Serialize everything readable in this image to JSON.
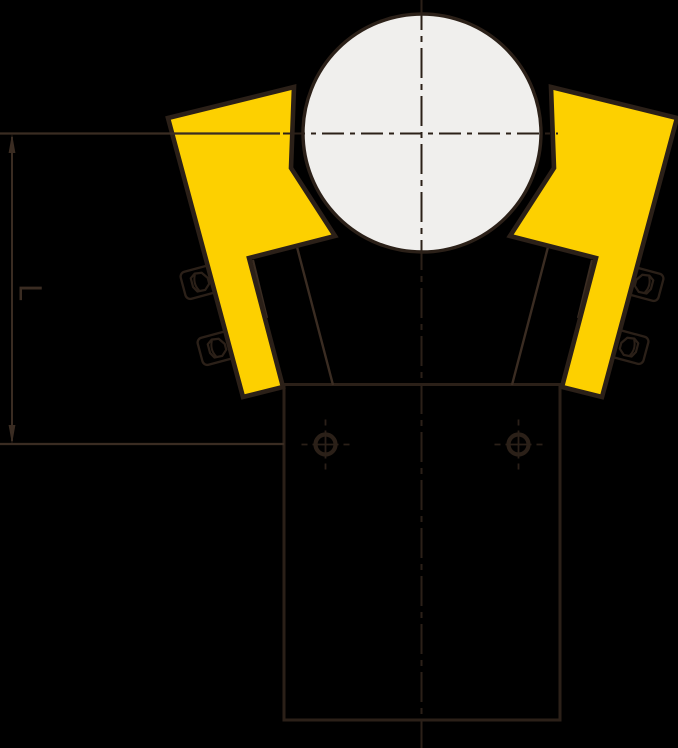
{
  "diagram": {
    "type": "technical-drawing",
    "description": "Side view of a clamp: round shaft gripped by two yellow jaws with side bolts, body with rectangular shank, two mounting holes, centerlines and vertical dimension L",
    "canvas": {
      "width": 678,
      "height": 748,
      "background": "#000000"
    },
    "colors": {
      "outline": "#2b2018",
      "thin": "#3a2c22",
      "yellow": "#fdd000",
      "roller": "#f0efed",
      "dim": "#3a2c22"
    },
    "dimension": {
      "label": "L"
    },
    "shapes": [
      {
        "type": "rect",
        "name": "shank-outline",
        "x": 284,
        "y": 384.5,
        "w": 276,
        "h": 335.5,
        "stroke": "outline",
        "sw": 3,
        "fill": "none"
      },
      {
        "type": "line",
        "name": "body-neck-edge-left",
        "x1": 297,
        "y1": 247,
        "x2": 333,
        "y2": 385,
        "stroke": "thin",
        "sw": 2.4
      },
      {
        "type": "line",
        "name": "body-neck-edge-right",
        "x1": 548,
        "y1": 247,
        "x2": 512,
        "y2": 385,
        "stroke": "thin",
        "sw": 2.4
      },
      {
        "type": "line",
        "name": "body-edge-stub-left",
        "x1": 253,
        "y1": 260,
        "x2": 267,
        "y2": 318,
        "stroke": "thin",
        "sw": 2.2
      },
      {
        "type": "line",
        "name": "body-edge-stub-right",
        "x1": 592,
        "y1": 260,
        "x2": 578,
        "y2": 318,
        "stroke": "thin",
        "sw": 2.2
      },
      {
        "type": "bolt",
        "name": "gib-bolt-left-upper",
        "cx": 200,
        "cy": 282,
        "rot": -15,
        "flip": false
      },
      {
        "type": "bolt",
        "name": "gib-bolt-left-lower",
        "cx": 217,
        "cy": 348,
        "rot": -15,
        "flip": false
      },
      {
        "type": "bolt",
        "name": "gib-bolt-right-upper",
        "cx": 644,
        "cy": 284,
        "rot": 15,
        "flip": true
      },
      {
        "type": "bolt",
        "name": "gib-bolt-right-lower",
        "cx": 629,
        "cy": 347,
        "rot": 15,
        "flip": true
      },
      {
        "type": "polygon",
        "name": "clamp-jaw-left",
        "points": [
          [
            168,
            118
          ],
          [
            294,
            87
          ],
          [
            291,
            168
          ],
          [
            335,
            236
          ],
          [
            249,
            258
          ],
          [
            283,
            387
          ],
          [
            243,
            397
          ]
        ],
        "fill": "yellow",
        "stroke": "outline",
        "sw": 4.6
      },
      {
        "type": "polygon",
        "name": "clamp-jaw-right",
        "points": [
          [
            677,
            118
          ],
          [
            551,
            87
          ],
          [
            554,
            168
          ],
          [
            510,
            236
          ],
          [
            596,
            258
          ],
          [
            562,
            387
          ],
          [
            602,
            397
          ]
        ],
        "fill": "yellow",
        "stroke": "outline",
        "sw": 4.6
      },
      {
        "type": "circle",
        "name": "shaft-roller",
        "cx": 422,
        "cy": 133,
        "r": 119,
        "fill": "roller",
        "stroke": "outline",
        "sw": 3.4
      },
      {
        "type": "line",
        "name": "centerline-vertical",
        "x1": 421.5,
        "y1": 0,
        "x2": 421.5,
        "y2": 748,
        "stroke": "outline",
        "sw": 2,
        "dash": "30 6 6 6"
      },
      {
        "type": "line",
        "name": "centerline-horizontal",
        "x1": 283,
        "y1": 133.5,
        "x2": 558,
        "y2": 133.5,
        "stroke": "outline",
        "sw": 2,
        "dash": "22 6 5 6"
      },
      {
        "type": "line",
        "name": "extension-line-top",
        "x1": 0,
        "y1": 133.5,
        "x2": 280,
        "y2": 133.5,
        "stroke": "thin",
        "sw": 2.2
      },
      {
        "type": "line",
        "name": "extension-line-bottom",
        "x1": 0,
        "y1": 444,
        "x2": 284,
        "y2": 444,
        "stroke": "thin",
        "sw": 2.2
      },
      {
        "type": "line",
        "name": "dimension-line-vertical",
        "x1": 12,
        "y1": 137,
        "x2": 12,
        "y2": 441,
        "stroke": "dim",
        "sw": 2
      },
      {
        "type": "polygon",
        "name": "dimension-arrow-up",
        "points": [
          [
            12,
            134
          ],
          [
            8.6,
            153
          ],
          [
            15.4,
            153
          ]
        ],
        "fill": "dim",
        "stroke": "none",
        "sw": 0
      },
      {
        "type": "polygon",
        "name": "dimension-arrow-down",
        "points": [
          [
            12,
            444
          ],
          [
            8.6,
            425
          ],
          [
            15.4,
            425
          ]
        ],
        "fill": "dim",
        "stroke": "none",
        "sw": 0
      },
      {
        "type": "hole",
        "name": "mounting-hole-left",
        "cx": 325.5,
        "cy": 444.5
      },
      {
        "type": "hole",
        "name": "mounting-hole-right",
        "cx": 518.5,
        "cy": 444.5
      }
    ]
  }
}
